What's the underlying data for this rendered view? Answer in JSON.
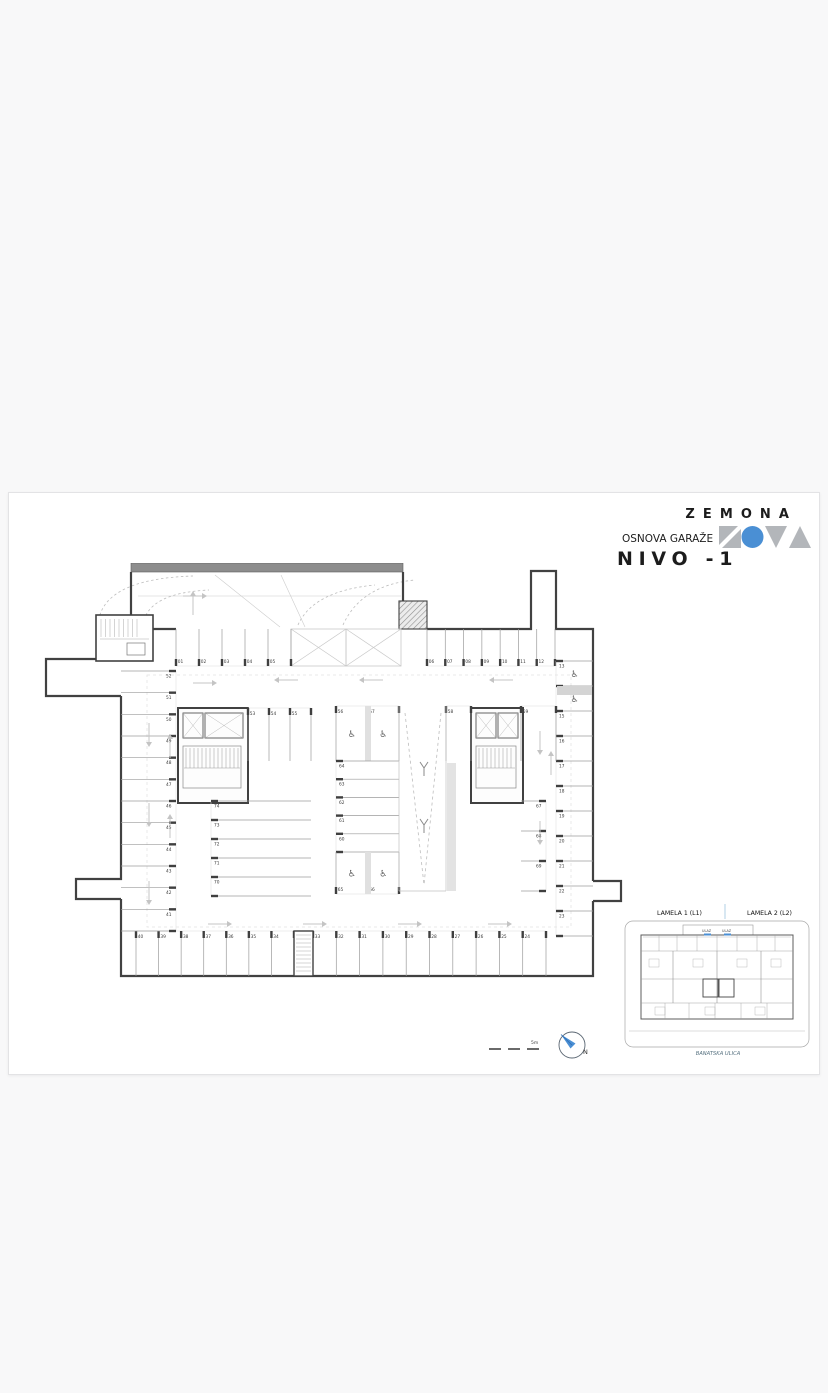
{
  "header": {
    "brand": "ZEMONA",
    "subtitle": "OSNOVA GARAŽE",
    "title": "NIVO -1"
  },
  "logo": {
    "shape_names": [
      "nova-n",
      "nova-o",
      "nova-v",
      "nova-a"
    ],
    "gray": "#b3b6ba",
    "blue": "#4a8fd4"
  },
  "plan": {
    "colors": {
      "wall": "#414141",
      "bar": "#8d8d8d",
      "divider": "#9b9b9b",
      "tick": "#3f3f3f",
      "number": "#3a3a3a",
      "arrow": "#c4c4c4",
      "dash": "#bdbdbd",
      "guide": "#cccccc",
      "texture": "#e0e0e0",
      "core": "#8a8a8a"
    },
    "icons": {
      "wheelchair": "♿"
    },
    "zones": {
      "top_row_left": [
        "01",
        "02",
        "03",
        "04",
        "05"
      ],
      "top_row_right": [
        "06",
        "07",
        "08",
        "09",
        "10",
        "11",
        "12"
      ],
      "right_col": [
        "13",
        "14",
        "15",
        "16",
        "17",
        "18",
        "19",
        "20",
        "21",
        "22",
        "23"
      ],
      "right_col_accessible": [
        "13",
        "14"
      ],
      "bottom_row_left": [
        "40",
        "39",
        "38",
        "37",
        "36",
        "35",
        "34"
      ],
      "bottom_row_right": [
        "33",
        "32",
        "31",
        "30",
        "29",
        "28",
        "27",
        "26",
        "25",
        "24"
      ],
      "left_col": [
        "52",
        "51",
        "50",
        "49",
        "48",
        "47",
        "46",
        "45",
        "44",
        "43",
        "42",
        "41"
      ],
      "inner_left_top": [
        "53",
        "54",
        "55"
      ],
      "inner_left_stack": [
        "74",
        "73",
        "72",
        "71",
        "70"
      ],
      "center_top": [
        "56",
        "57"
      ],
      "center_top_accessible": [
        "56",
        "57"
      ],
      "center_right_top": [
        "58"
      ],
      "right_core_top": [
        "59"
      ],
      "center_stack": [
        "64",
        "63",
        "62",
        "61",
        "60"
      ],
      "center_bottom": [
        "65",
        "66"
      ],
      "center_bottom_accessible": [
        "65",
        "66"
      ],
      "inner_right_col": [
        "67",
        "68",
        "69"
      ]
    }
  },
  "footer": {
    "scale_label": "5m",
    "north_label": "N"
  },
  "inset": {
    "lamela1": "LAMELA 1  (L1)",
    "lamela2": "LAMELA 2  (L2)",
    "entrance1": "ULAZ",
    "entrance2": "ULAZ",
    "street": "BANATSKA ULICA",
    "accent_blue": "#4a8fd4"
  }
}
